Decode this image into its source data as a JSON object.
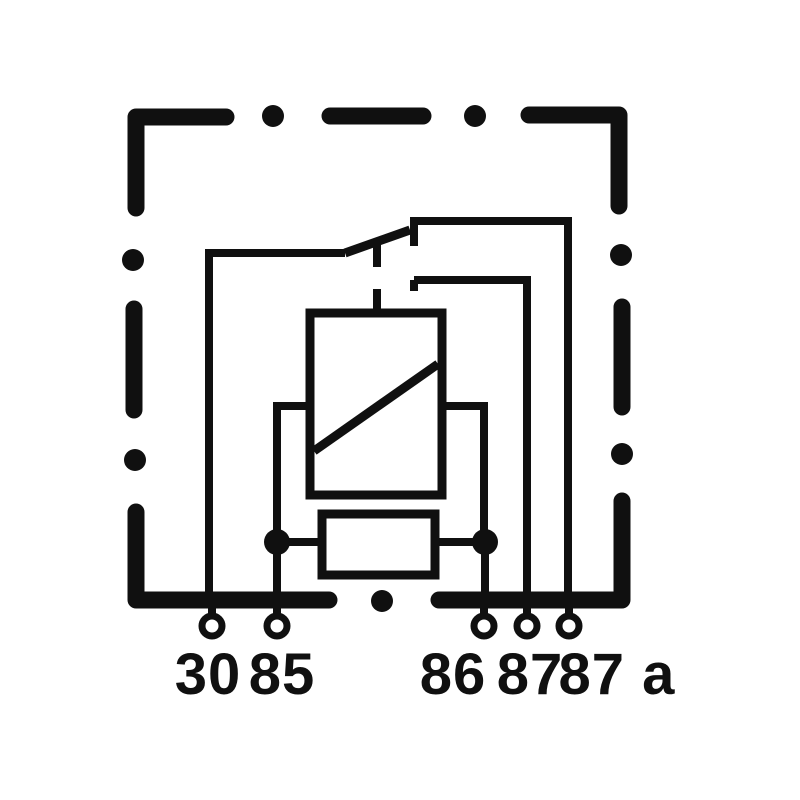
{
  "diagram": {
    "kind": "relay-wiring-circuit-diagram",
    "colors": {
      "ink": "#101010",
      "background": "#ffffff"
    },
    "terminals": [
      {
        "id": "30",
        "label": "30"
      },
      {
        "id": "85",
        "label": "85"
      },
      {
        "id": "86",
        "label": "86"
      },
      {
        "id": "87",
        "label": "87"
      },
      {
        "id": "87a",
        "label": "87 a"
      }
    ],
    "components": {
      "coil": "relay-coil",
      "resistor": "resistor",
      "switch": "changeover-contact"
    }
  }
}
